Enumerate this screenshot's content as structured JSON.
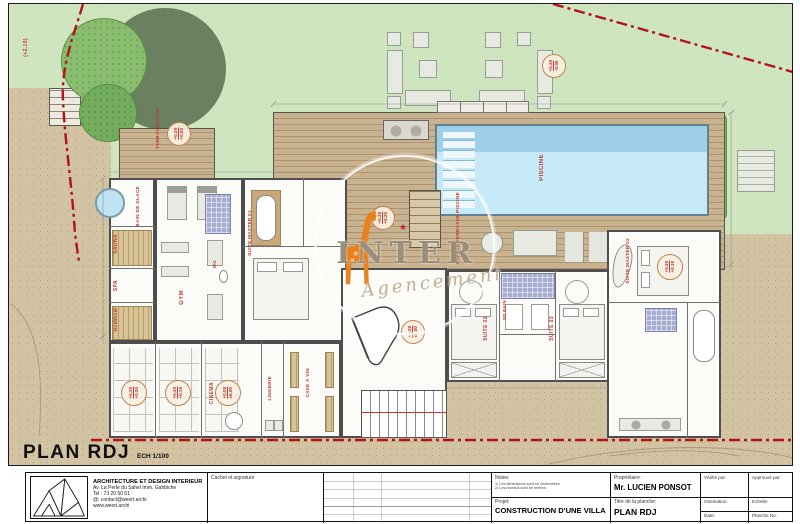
{
  "plan": {
    "title": "PLAN RDJ",
    "scale": "ECH 1/100"
  },
  "watermark": {
    "name": "INTER",
    "script": "Agencement",
    "star": "★"
  },
  "rooms": {
    "piscine": "PISCINE",
    "espace_terrasse": "ESPACE TERRASSE PISCINE",
    "terrasse_gym": "TERRASSE GYM",
    "bain_de_glace": "BAIN DE GLACE",
    "sauna": "SAUNA",
    "spa": "SPA",
    "hammam": "HAMMAM",
    "gym": "GYM",
    "wc": "WC",
    "suite_master_01": "SUITE MASTER 01",
    "cinema": "CINEMA",
    "lingerie": "LINGERIE",
    "cave_a_vin": "CAVE À VIN",
    "suite_02": "SUITE 02",
    "suite_03": "SUITE 03",
    "sd_bain": "SD BAIN",
    "suite_master_02": "SUITE MASTER 02"
  },
  "levels": {
    "garden": {
      "top": "+0.38",
      "bottom": "-0.95"
    },
    "terrasse_gym": {
      "top": "+0.38",
      "bottom": "+0.25"
    },
    "deck": {
      "top": "+0.38",
      "bottom": "+0.25"
    },
    "cinema1": {
      "top": "+0.38",
      "bottom": "+0.25"
    },
    "cinema2": {
      "top": "+0.38",
      "bottom": "+0.18"
    },
    "cinema3": {
      "top": "+0.08",
      "bottom": "±0.00"
    },
    "sejour": {
      "top": "+0.38",
      "bottom": "±0.00"
    },
    "suite_master_02": {
      "top": "+0.38",
      "bottom": "+0.18"
    },
    "slope": "(+2.10)"
  },
  "title_block": {
    "company": "ARCHITECTURE ET DESIGN INTERIEUR",
    "address": "Av. La Perle du Sahel Imm. Gahbiche",
    "tel": "Tel : 73 20 50 51",
    "email": "@: contact@weert.archi",
    "website": "www.weert.archi",
    "cachet_label": "Cachet et signature",
    "notes_label": "Notes:",
    "note1": "1/ Les dimensions sont en centimètres",
    "note2": "2/ Les niveaux sont en mètres",
    "proprietaire_label": "Propriétaire :",
    "proprietaire": "Mr. LUCIEN PONSOT",
    "projet_label": "Projet:",
    "projet": "CONSTRUCTION D'UNE VILLA",
    "titre_label": "Titre de la planche:",
    "titre": "PLAN RDJ",
    "verifie_label": "Vérifié par:",
    "approuve_label": "Approuvé par:",
    "orientation_label": "Orientation:",
    "echelle_label": "Echelle:",
    "date_label": "Date:",
    "planche_label": "Planche No."
  }
}
